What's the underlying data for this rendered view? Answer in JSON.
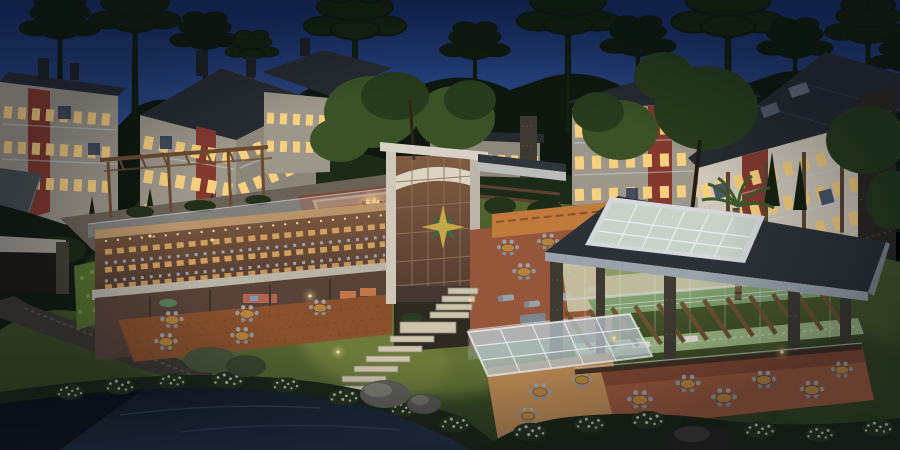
{
  "meta": {
    "kind": "3d-architectural-rendering",
    "setting": "aerial dusk view of a condominium resort clubhouse with restaurant, pools pavilion, rooftop fire pit, pergolas, lawns and a pond, surrounded by apartment buildings and araucaria pine trees",
    "time_of_day": "dusk",
    "text_visible": "none"
  },
  "scene": {
    "features": [
      "araucaria-pine-trees",
      "apartment-buildings-lit-windows",
      "glass-restaurant-wing",
      "rooftop-pergola-deck",
      "sunken-fire-pit-lounge",
      "glass-atrium-tower-with-star-emblem",
      "indoor-pool-pavilion-with-roof-skylight",
      "outdoor-dining-patios",
      "stone-stairway",
      "pond-with-white-flowering-shrubs",
      "stone-retaining-wall"
    ],
    "counts": {
      "background_buildings": 5,
      "araucaria_trees": 12,
      "patio_tables": 14,
      "pools": 2
    }
  },
  "palette": {
    "sky_top": "#142a5e",
    "sky_mid": "#2e4d8c",
    "sky_horizon": "#7b90b4",
    "forest": "#0e180e",
    "forest_mid": "#1e2e1a",
    "canopy_lit": "#3a5226",
    "roof": "#262b31",
    "facade": "#cfc8ba",
    "facade_dim": "#9d968a",
    "brick": "#84392e",
    "window_lit": "#f6cf7f",
    "window_dark": "#3a4a62",
    "wood": "#6b4a2f",
    "deck": "#8a512c",
    "glass": "#aebdcd",
    "terracotta": "#96563a",
    "fire": "#ffb85c",
    "star_gold": "#c9a733",
    "star_green": "#2f5a31",
    "pool": "#9cb682",
    "pool_deep": "#7f9f6e",
    "stone": "#3e3a32",
    "lawn": "#55652f",
    "lawn_dark": "#2e3d1f",
    "lawn_lit": "#76843e",
    "water": "#11161e",
    "water_light": "#243044",
    "flowers": "#d3dacc",
    "steps": "#cdc4ae",
    "pav_roof": "#2c3137",
    "fascia": "#9aa2aa",
    "skylight": "#c7d2c8",
    "table_wood": "#b5823f",
    "chair": "#98a0a8",
    "interior_warm": "#7a4e2c",
    "interior_dark": "#45291a"
  }
}
